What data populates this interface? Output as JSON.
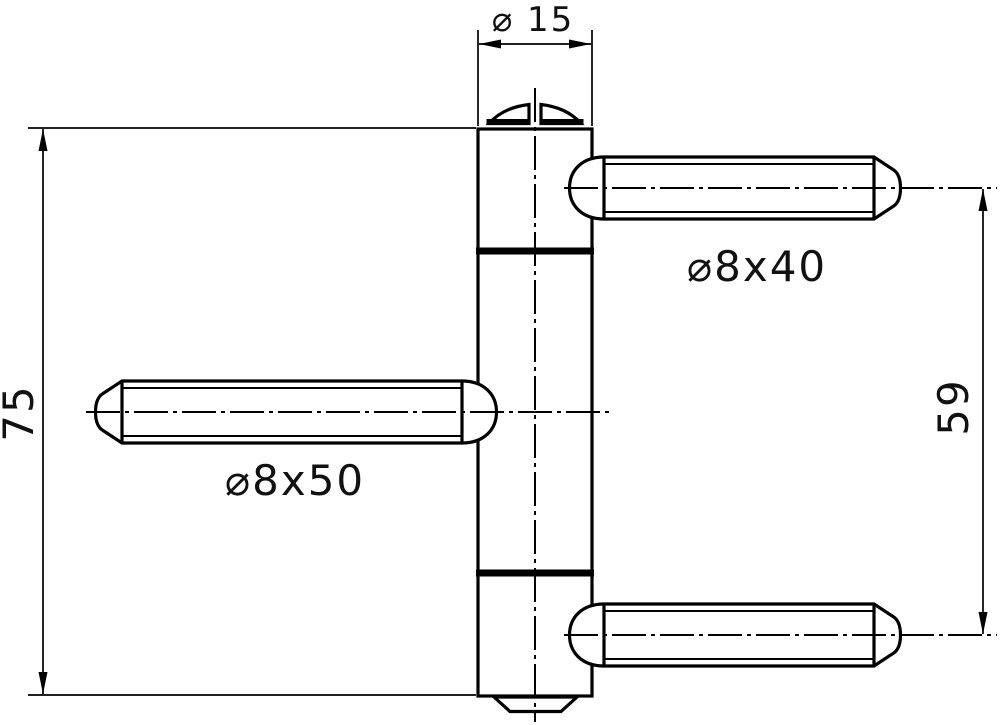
{
  "drawing": {
    "kind": "technical-drawing",
    "subject": "three-part drill-in door hinge, side elevation",
    "colors": {
      "line": "#000000",
      "background": "#ffffff"
    },
    "labels": {
      "barrel_diameter": "⌀ 15",
      "hinge_height": "75",
      "pin_spacing": "59",
      "pin_top_right": "⌀8x40",
      "pin_middle_left": "⌀8x50"
    }
  }
}
